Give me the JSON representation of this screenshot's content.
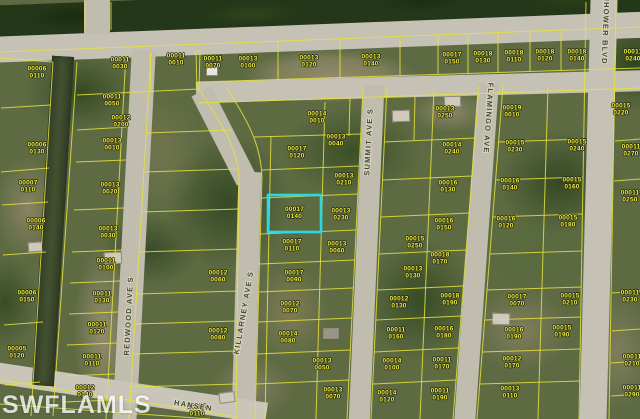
{
  "map": {
    "source_watermark": "SWFLAMLS",
    "highlight": {
      "x": 268,
      "y": 195,
      "w": 53,
      "h": 37,
      "color": "#2BD8E2",
      "parcel_line1": "00017",
      "parcel_line2": "0140"
    },
    "streets": [
      {
        "name": "REDWOOD AVE S",
        "x": 131,
        "y": 316,
        "rotate": -87
      },
      {
        "name": "KILLARNEY AVE S",
        "x": 246,
        "y": 313,
        "rotate": -80
      },
      {
        "name": "SUMMIT AVE S",
        "x": 371,
        "y": 142,
        "rotate": -87
      },
      {
        "name": "FLAMINGO AVE",
        "x": 486,
        "y": 118,
        "rotate": 94
      },
      {
        "name": "NHOWER BLVD",
        "x": 603,
        "y": 30,
        "rotate": 92
      },
      {
        "name": "HANSEN",
        "x": 193,
        "y": 408,
        "rotate": 9
      }
    ],
    "parcel_labels": [
      {
        "a": "00006",
        "b": "0110",
        "x": 37,
        "y": 72
      },
      {
        "a": "00006",
        "b": "0130",
        "x": 37,
        "y": 148
      },
      {
        "a": "00007",
        "b": "0110",
        "x": 28,
        "y": 186
      },
      {
        "a": "00006",
        "b": "0140",
        "x": 36,
        "y": 224
      },
      {
        "a": "00006",
        "b": "0150",
        "x": 27,
        "y": 296
      },
      {
        "a": "00005",
        "b": "0120",
        "x": 17,
        "y": 352
      },
      {
        "a": "00011",
        "b": "0050",
        "x": 112,
        "y": 100
      },
      {
        "a": "00012",
        "b": "0200",
        "x": 121,
        "y": 121
      },
      {
        "a": "00013",
        "b": "0010",
        "x": 112,
        "y": 144
      },
      {
        "a": "00013",
        "b": "0020",
        "x": 110,
        "y": 188
      },
      {
        "a": "00013",
        "b": "0030",
        "x": 108,
        "y": 232
      },
      {
        "a": "00011",
        "b": "0100",
        "x": 106,
        "y": 264
      },
      {
        "a": "00011",
        "b": "0130",
        "x": 102,
        "y": 297
      },
      {
        "a": "00011",
        "b": "0120",
        "x": 97,
        "y": 328
      },
      {
        "a": "00011",
        "b": "0110",
        "x": 92,
        "y": 360
      },
      {
        "a": "00012",
        "b": "0140",
        "x": 85,
        "y": 391
      },
      {
        "a": "00011",
        "b": "0030",
        "x": 120,
        "y": 63
      },
      {
        "a": "00011",
        "b": "0010",
        "x": 176,
        "y": 59
      },
      {
        "a": "00011",
        "b": "0070",
        "x": 213,
        "y": 62
      },
      {
        "a": "00013",
        "b": "0100",
        "x": 248,
        "y": 62
      },
      {
        "a": "00013",
        "b": "0120",
        "x": 309,
        "y": 61
      },
      {
        "a": "00013",
        "b": "0140",
        "x": 371,
        "y": 60
      },
      {
        "a": "00017",
        "b": "0150",
        "x": 452,
        "y": 58
      },
      {
        "a": "00018",
        "b": "0130",
        "x": 483,
        "y": 57
      },
      {
        "a": "00018",
        "b": "0110",
        "x": 514,
        "y": 56
      },
      {
        "a": "00018",
        "b": "0120",
        "x": 545,
        "y": 55
      },
      {
        "a": "00018",
        "b": "0140",
        "x": 577,
        "y": 55
      },
      {
        "a": "00011",
        "b": "0240",
        "x": 633,
        "y": 55
      },
      {
        "a": "00014",
        "b": "0010",
        "x": 317,
        "y": 117
      },
      {
        "a": "00013",
        "b": "0250",
        "x": 445,
        "y": 112
      },
      {
        "a": "00019",
        "b": "0010",
        "x": 512,
        "y": 111
      },
      {
        "a": "00015",
        "b": "0220",
        "x": 621,
        "y": 109
      },
      {
        "a": "00014",
        "b": "0240",
        "x": 452,
        "y": 148
      },
      {
        "a": "00015",
        "b": "0230",
        "x": 515,
        "y": 146
      },
      {
        "a": "00015",
        "b": "0240",
        "x": 577,
        "y": 145
      },
      {
        "a": "00016",
        "b": "0130",
        "x": 448,
        "y": 186
      },
      {
        "a": "00016",
        "b": "0140",
        "x": 510,
        "y": 184
      },
      {
        "a": "00015",
        "b": "0160",
        "x": 572,
        "y": 183
      },
      {
        "a": "00016",
        "b": "0150",
        "x": 444,
        "y": 224
      },
      {
        "a": "00016",
        "b": "0120",
        "x": 506,
        "y": 222
      },
      {
        "a": "00015",
        "b": "0180",
        "x": 568,
        "y": 221
      },
      {
        "a": "00018",
        "b": "0170",
        "x": 440,
        "y": 258
      },
      {
        "a": "00011",
        "b": "0270",
        "x": 631,
        "y": 150
      },
      {
        "a": "00011",
        "b": "0250",
        "x": 630,
        "y": 196
      },
      {
        "a": "00013",
        "b": "0040",
        "x": 336,
        "y": 140
      },
      {
        "a": "00013",
        "b": "0210",
        "x": 344,
        "y": 179
      },
      {
        "a": "00013",
        "b": "0230",
        "x": 341,
        "y": 214
      },
      {
        "a": "00013",
        "b": "0060",
        "x": 337,
        "y": 247
      },
      {
        "a": "00017",
        "b": "0120",
        "x": 297,
        "y": 152
      },
      {
        "a": "00017",
        "b": "0110",
        "x": 292,
        "y": 245
      },
      {
        "a": "00017",
        "b": "0090",
        "x": 294,
        "y": 276
      },
      {
        "a": "00012",
        "b": "0070",
        "x": 290,
        "y": 307
      },
      {
        "a": "00014",
        "b": "0080",
        "x": 288,
        "y": 337
      },
      {
        "a": "00013",
        "b": "0050",
        "x": 322,
        "y": 364
      },
      {
        "a": "00013",
        "b": "0070",
        "x": 333,
        "y": 393
      },
      {
        "a": "00012",
        "b": "0110",
        "x": 197,
        "y": 410
      },
      {
        "a": "00012",
        "b": "0060",
        "x": 218,
        "y": 276
      },
      {
        "a": "00012",
        "b": "0080",
        "x": 218,
        "y": 334
      },
      {
        "a": "00015",
        "b": "0250",
        "x": 415,
        "y": 242
      },
      {
        "a": "00013",
        "b": "0130",
        "x": 413,
        "y": 272
      },
      {
        "a": "00012",
        "b": "0130",
        "x": 399,
        "y": 302
      },
      {
        "a": "00011",
        "b": "0160",
        "x": 396,
        "y": 333
      },
      {
        "a": "00014",
        "b": "0100",
        "x": 392,
        "y": 364
      },
      {
        "a": "00014",
        "b": "0120",
        "x": 387,
        "y": 396
      },
      {
        "a": "00018",
        "b": "0190",
        "x": 450,
        "y": 299
      },
      {
        "a": "00017",
        "b": "0070",
        "x": 517,
        "y": 300
      },
      {
        "a": "00015",
        "b": "0210",
        "x": 570,
        "y": 299
      },
      {
        "a": "00016",
        "b": "0180",
        "x": 444,
        "y": 332
      },
      {
        "a": "00016",
        "b": "0190",
        "x": 514,
        "y": 333
      },
      {
        "a": "00015",
        "b": "0190",
        "x": 562,
        "y": 331
      },
      {
        "a": "00011",
        "b": "0170",
        "x": 442,
        "y": 363
      },
      {
        "a": "00012",
        "b": "0170",
        "x": 512,
        "y": 362
      },
      {
        "a": "00011",
        "b": "0190",
        "x": 440,
        "y": 394
      },
      {
        "a": "00013",
        "b": "0110",
        "x": 510,
        "y": 392
      },
      {
        "a": "00011",
        "b": "0230",
        "x": 630,
        "y": 296
      },
      {
        "a": "00011",
        "b": "0210",
        "x": 632,
        "y": 360
      },
      {
        "a": "00011",
        "b": "0290",
        "x": 632,
        "y": 391
      }
    ]
  }
}
